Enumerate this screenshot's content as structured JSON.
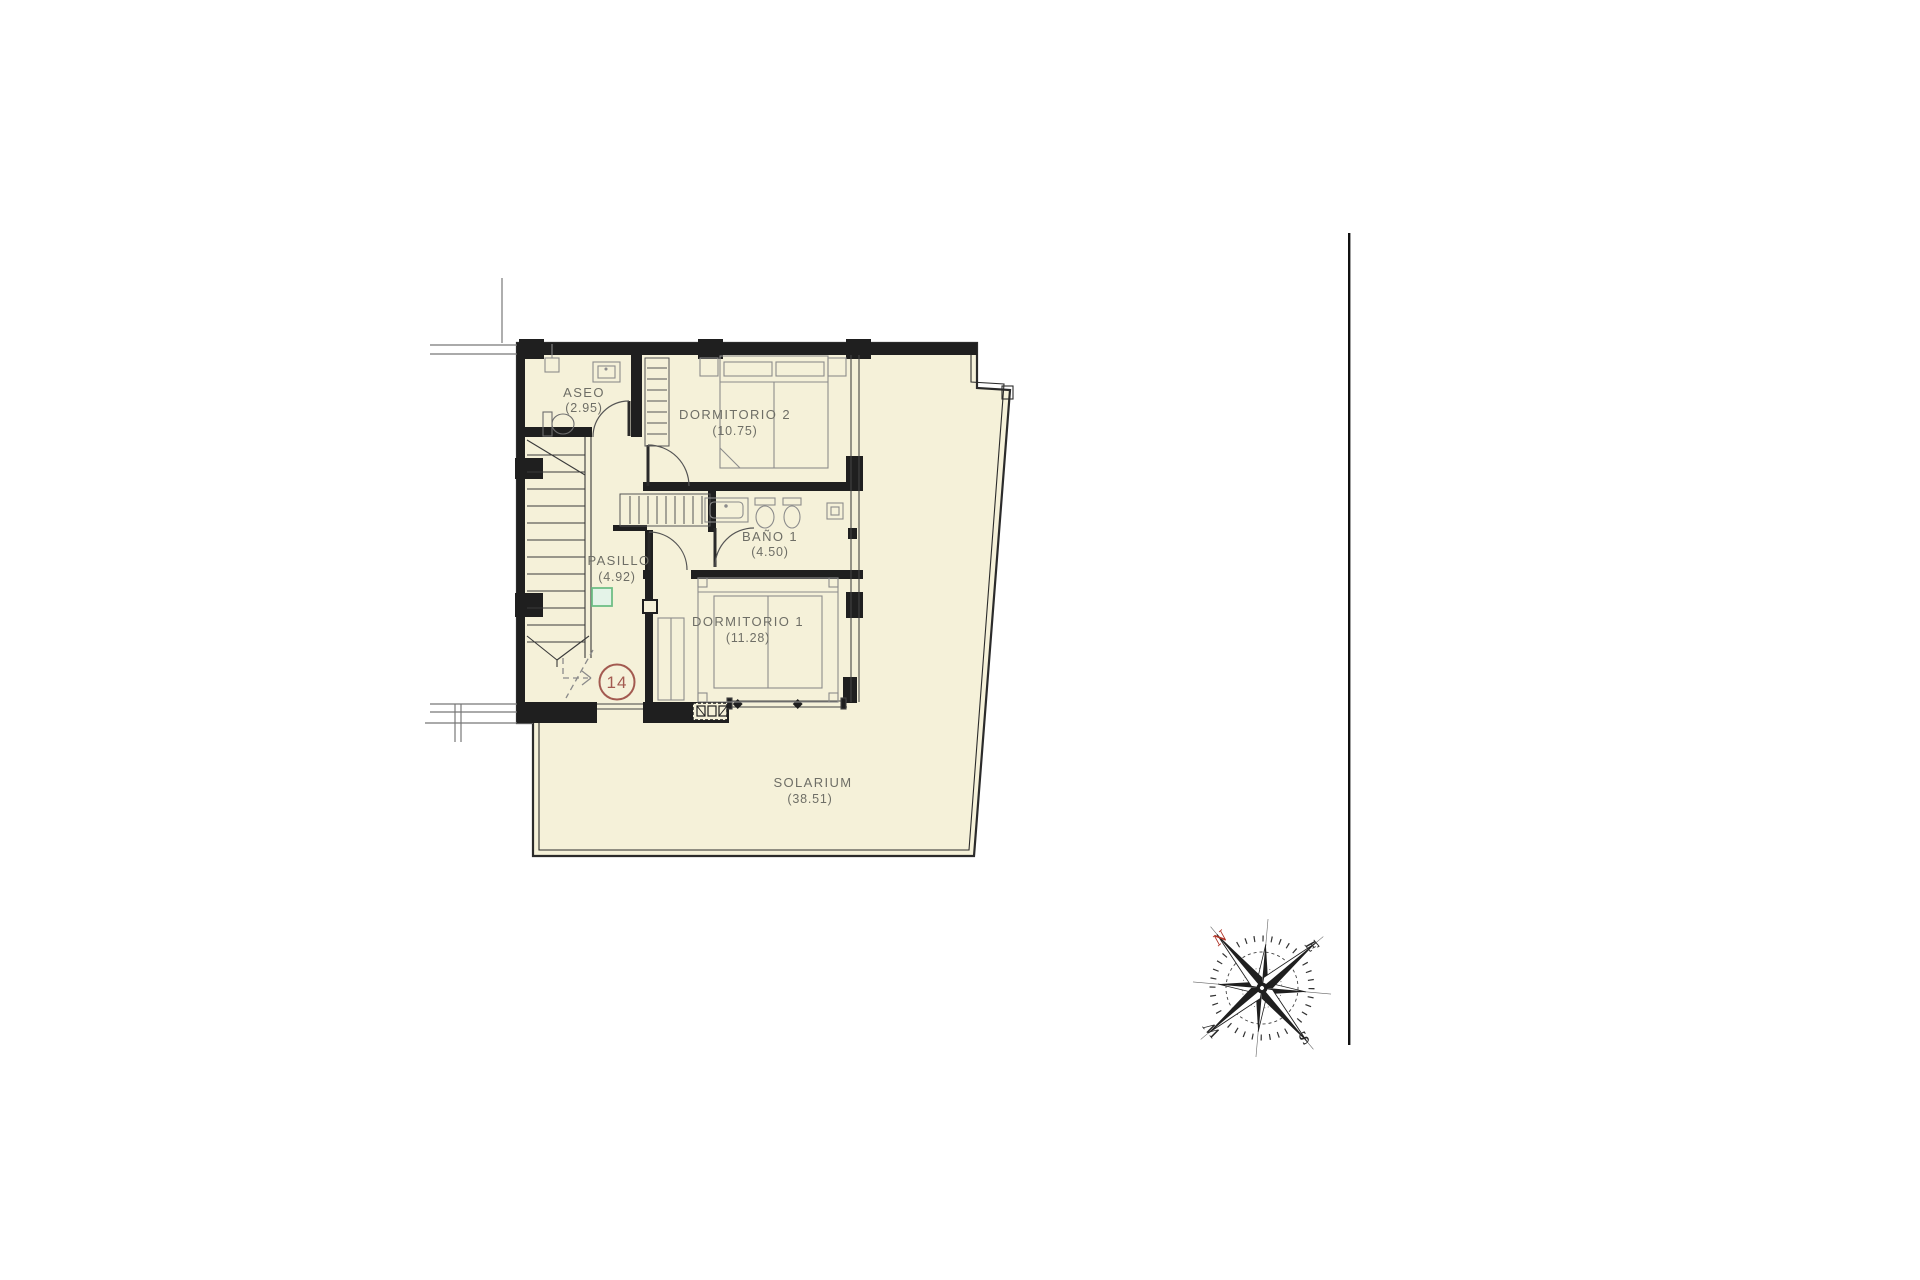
{
  "page": {
    "background": "#ffffff"
  },
  "plan": {
    "unit_badge": "14",
    "rooms": [
      {
        "id": "aseo",
        "name": "ASEO",
        "area": "(2.95)"
      },
      {
        "id": "dormitorio2",
        "name": "DORMITORIO 2",
        "area": "(10.75)"
      },
      {
        "id": "bano1",
        "name": "BAÑO 1",
        "area": "(4.50)"
      },
      {
        "id": "pasillo",
        "name": "PASILLO",
        "area": "(4.92)"
      },
      {
        "id": "dormitorio1",
        "name": "DORMITORIO 1",
        "area": "(11.28)"
      },
      {
        "id": "solarium",
        "name": "SOLARIUM",
        "area": "(38.51)"
      }
    ],
    "colors": {
      "floor": "#f5f1d9",
      "wall": "#1f1f1f",
      "thin_line": "#555555",
      "furniture": "#8c8c8c",
      "label": "#6e6e66",
      "badge": "#a35a50",
      "accent_green": "#6fbe85"
    }
  },
  "compass": {
    "labels": {
      "north": "N",
      "east": "E",
      "south": "S",
      "west": "W"
    },
    "north_color": "#b03427"
  }
}
